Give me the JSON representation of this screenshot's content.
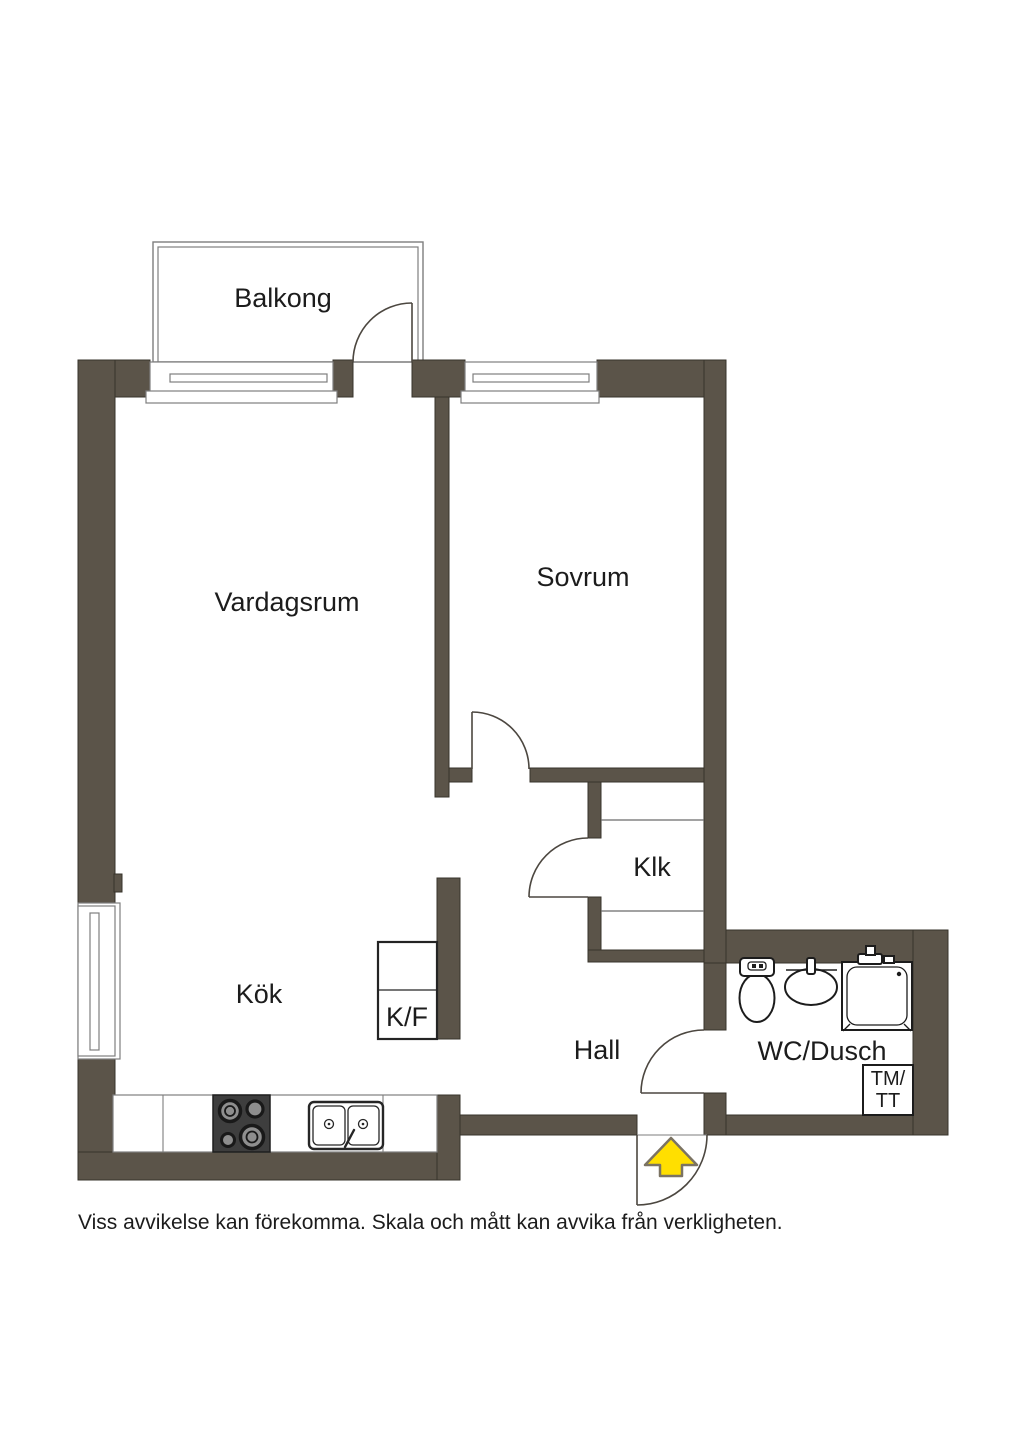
{
  "plan": {
    "rooms": {
      "balcony": "Balkong",
      "living_room": "Vardagsrum",
      "bedroom": "Sovrum",
      "closet": "Klk",
      "kitchen": "Kök",
      "hall": "Hall",
      "bathroom": "WC/Dusch"
    },
    "appliances": {
      "fridge_freezer": "K/F",
      "washer_dryer_line1": "TM/",
      "washer_dryer_line2": "TT"
    },
    "disclaimer": "Viss avvikelse kan förekomma. Skala och mått kan avvika från verkligheten."
  },
  "colors": {
    "wall": "#5b5449",
    "wallstroke": "#37332b",
    "line": "#4c4740",
    "frame": "#7e7e7e",
    "fix": "#1c1c1c",
    "stove": "#3e3e3e",
    "burner": "#8e8e8e",
    "arrow": "#ffdf00",
    "arrowstroke": "#7b7363",
    "text": "#1c1c1c",
    "bg": "#ffffff"
  }
}
